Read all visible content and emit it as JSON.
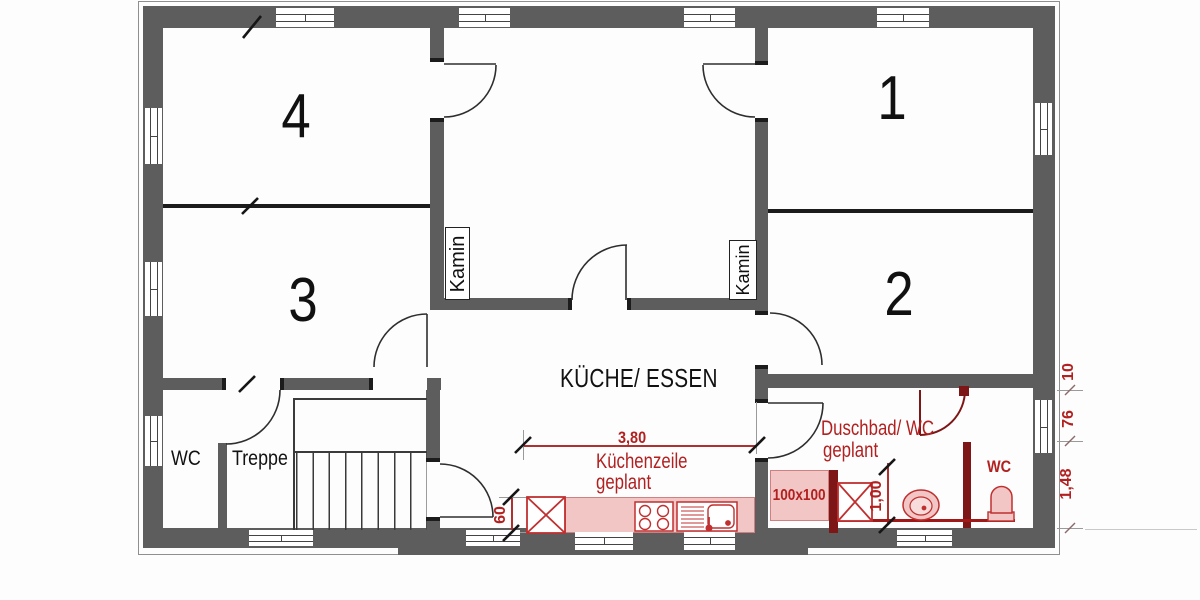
{
  "rooms": {
    "r1": "1",
    "r2": "2",
    "r3": "3",
    "r4": "4"
  },
  "labels": {
    "kitchen": "KÜCHE/ ESSEN",
    "wc": "WC",
    "stairs": "Treppe",
    "chimney": "Kamin"
  },
  "planned": {
    "bath_line1": "Duschbad/ WC",
    "bath_line2": "geplant",
    "kitchen_line1": "Küchenzeile",
    "kitchen_line2": "geplant",
    "wc_label": "WC",
    "shower_size": "100x100"
  },
  "dimensions": {
    "kitchen_run": "3,80",
    "counter_depth": "60",
    "shower_width": "1,00",
    "right_chain": [
      "10",
      "76",
      "1,48"
    ]
  },
  "colors": {
    "wall_gray": "#5d5d5d",
    "partition_black": "#1c1c1c",
    "planned_red_text": "#b22020",
    "planned_red_stroke": "#c03030",
    "planned_wall_darkred": "#7d1616",
    "planned_fill_pink": "#f3c6c6"
  }
}
